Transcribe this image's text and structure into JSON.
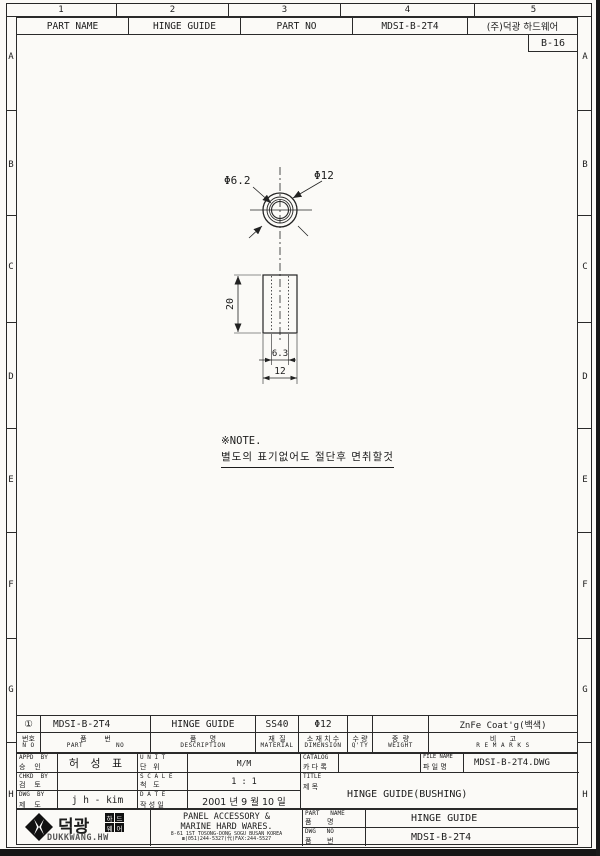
{
  "sheet": {
    "zone_numbers": [
      "1",
      "2",
      "3",
      "4",
      "5"
    ],
    "zone_letters": [
      "A",
      "B",
      "C",
      "D",
      "E",
      "F",
      "G",
      "H"
    ],
    "sheet_no": "B-16",
    "header": {
      "part_name_label": "PART NAME",
      "part_name": "HINGE GUIDE",
      "part_no_label": "PART NO",
      "part_no": "MDSI-B-2T4",
      "company": "(주)덕광 하드웨어"
    }
  },
  "drawing": {
    "labels": {
      "inner_dia": "Φ6.2",
      "outer_dia": "Φ12",
      "height": "20",
      "hole_width": "6.3",
      "body_width": "12"
    },
    "note_title": "※NOTE.",
    "note_body": "별도의 표기없어도 절단후 면취할것"
  },
  "parts_table": {
    "headers": [
      {
        "ko": "번호",
        "en": "N O"
      },
      {
        "ko": "품        번",
        "en": "PART        NO"
      },
      {
        "ko": "품      명",
        "en": "DESCRIPTION"
      },
      {
        "ko": "재  질",
        "en": "MATERIAL"
      },
      {
        "ko": "소 재 치 수",
        "en": "DIMENSION"
      },
      {
        "ko": "수 량",
        "en": "Q'TY"
      },
      {
        "ko": "중  량",
        "en": "WEIGHT"
      },
      {
        "ko": "비      고",
        "en": "R E M A R K S"
      }
    ],
    "row": {
      "no": "①",
      "part_no": "MDSI-B-2T4",
      "description": "HINGE GUIDE",
      "material": "SS40",
      "dimension": "Φ12",
      "qty": "",
      "weight": "",
      "remarks": "ZnFe Coat'g(백색)"
    }
  },
  "approval": {
    "appd": {
      "en": "APPD  BY",
      "ko": "승    인",
      "value": "허 성 표"
    },
    "chkd": {
      "en": "CHKD  BY",
      "ko": "검    토",
      "value": ""
    },
    "dwg": {
      "en": "DWG  BY",
      "ko": "제    도",
      "value": "j h - kim"
    },
    "unit": {
      "en": "U N I T",
      "ko": "단   위",
      "value": "M/M"
    },
    "scale": {
      "en": "S C A L E",
      "ko": "척   도",
      "value": "1 : 1"
    },
    "date": {
      "en": "D A T E",
      "ko": "작 성 일",
      "value": "2001 년 9 월 10 일"
    },
    "catalog": {
      "en": "CATALOG",
      "ko": "카 다 록",
      "value": ""
    },
    "file": {
      "en": "FILE NAME",
      "ko": "파 일 명",
      "value": "MDSI-B-2T4.DWG"
    },
    "title": {
      "en": "TITLE",
      "ko": "제 목",
      "value": "HINGE GUIDE(BUSHING)"
    }
  },
  "footer": {
    "logo_korean": "덕광",
    "logo_blocks": [
      "하",
      "드",
      "웨",
      "어"
    ],
    "logo_roman": "DUKKWANG.HW",
    "company_line1": "PANEL ACCESSORY &",
    "company_line2": "MARINE HARD WARES.",
    "address": "8-61 1ST TOSONG-DONG SOGU BUSAN KOREA",
    "phone": "☎(051)244-5327(代)FAX:244-5527",
    "part_name": {
      "en": "PART   NAME",
      "ko": "품       명",
      "value": "HINGE GUIDE"
    },
    "dwg_no": {
      "en": "DWG   NO",
      "ko": "품       번",
      "value": "MDSI-B-2T4"
    }
  }
}
